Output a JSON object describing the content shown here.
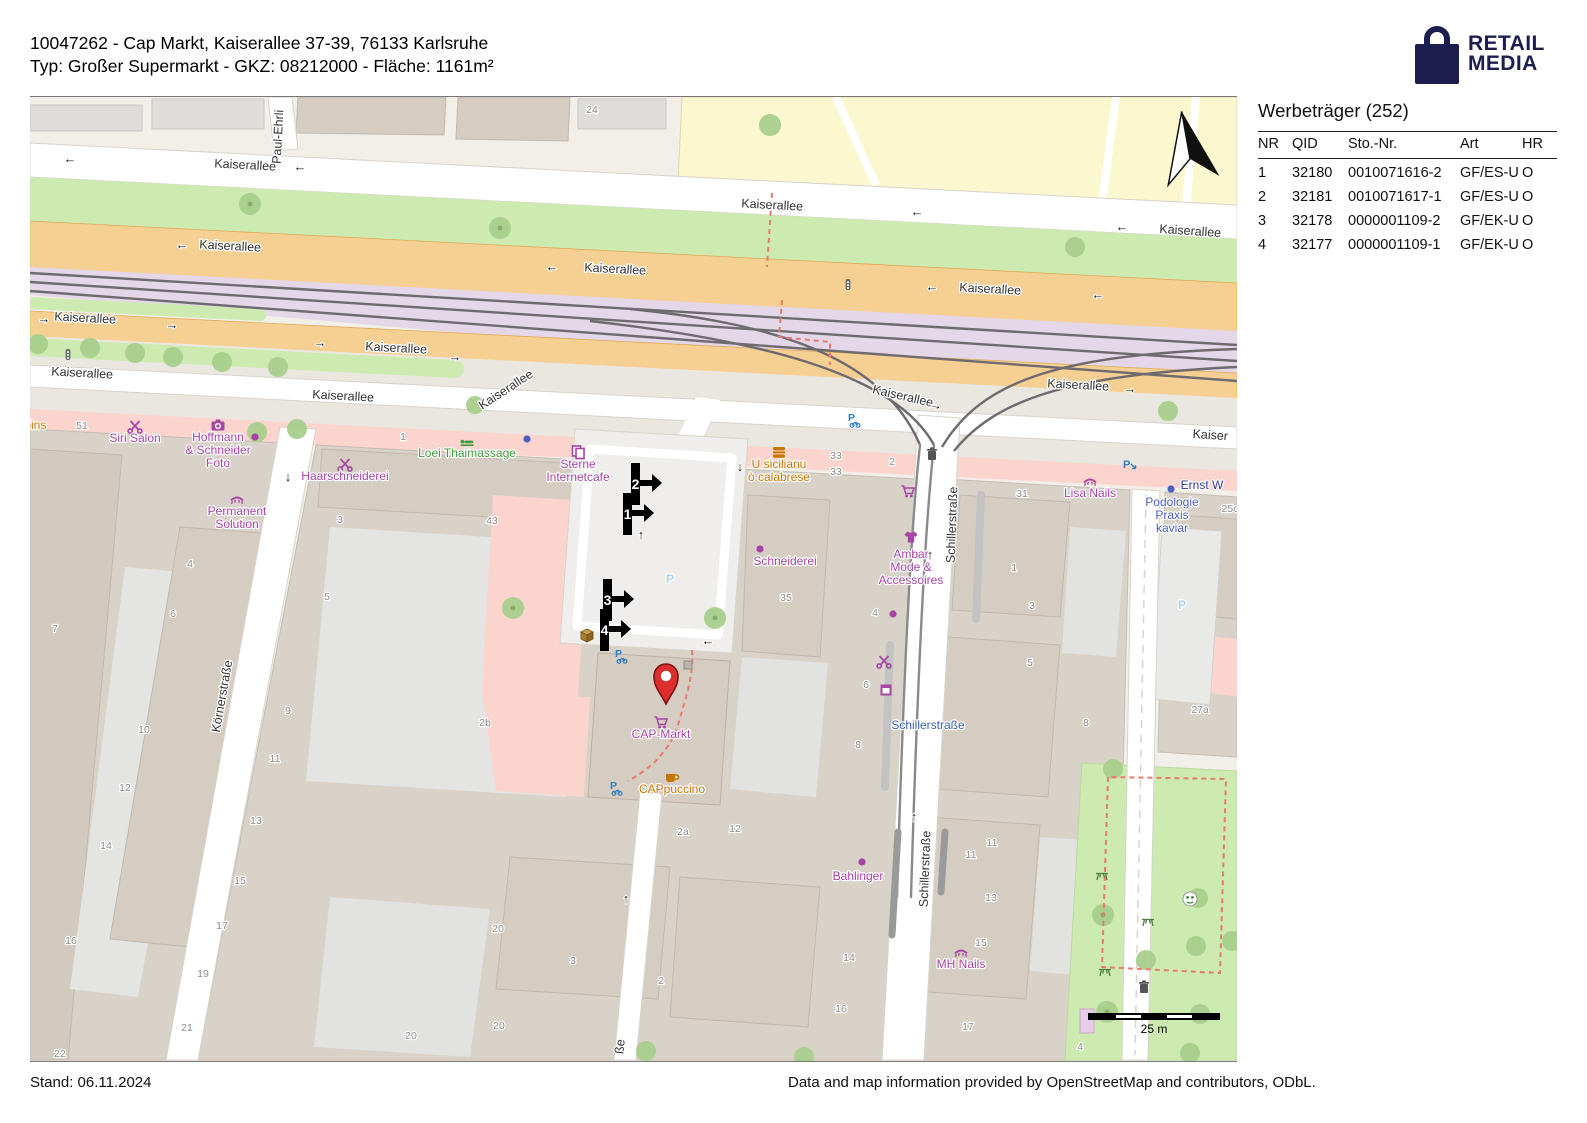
{
  "header": {
    "line1": "10047262 - Cap Markt, Kaiserallee 37-39, 76133 Karlsruhe",
    "line2": "Typ: Großer Supermarkt - GKZ: 08212000 - Fläche: 1161m²"
  },
  "logo": {
    "line1": "RETAIL",
    "line2": "MEDIA",
    "color": "#1d1d4f"
  },
  "panel": {
    "title": "Werbeträger (252)",
    "columns": [
      "NR",
      "QID",
      "Sto.-Nr.",
      "Art",
      "HR"
    ],
    "rows": [
      {
        "nr": "1",
        "qid": "32180",
        "sto": "0010071616-2",
        "art": "GF/ES-U",
        "hr": "O"
      },
      {
        "nr": "2",
        "qid": "32181",
        "sto": "0010071617-1",
        "art": "GF/ES-U",
        "hr": "O"
      },
      {
        "nr": "3",
        "qid": "32178",
        "sto": "0000001109-2",
        "art": "GF/EK-U",
        "hr": "O"
      },
      {
        "nr": "4",
        "qid": "32177",
        "sto": "0000001109-1",
        "art": "GF/EK-U",
        "hr": "O"
      }
    ]
  },
  "footer": {
    "stand": "Stand: 06.11.2024",
    "attribution": "Data and map information provided by OpenStreetMap and contributors, ODbL."
  },
  "map": {
    "scale_label": "25 m",
    "colors": {
      "road_orange": "#f6cf92",
      "tram_purple": "#e3d7e8",
      "grass_green": "#cdebb0",
      "pink_zone": "#fbd4cd",
      "yellow_zone": "#fbf8cf",
      "building": "#d6cdc2",
      "poi_purple": "#a645a6",
      "poi_orange": "#c77400",
      "poi_green": "#3f9c39",
      "poi_blue": "#4a5fc0",
      "stop_blue": "#3c5fae",
      "parking_blue": "#aed2ee",
      "bike_blue": "#2e7ec2",
      "pin_red": "#dd2e2e",
      "marker_black": "#000000"
    },
    "street_labels": [
      {
        "t": "Kaiserallee",
        "x": 215,
        "y": 72,
        "r": 3
      },
      {
        "t": "Kaiserallee",
        "x": 742,
        "y": 112,
        "r": 3
      },
      {
        "t": "Kaiserallee",
        "x": 1160,
        "y": 138,
        "r": 4
      },
      {
        "t": "Kaiserallee",
        "x": 200,
        "y": 153,
        "r": 3
      },
      {
        "t": "Kaiserallee",
        "x": 585,
        "y": 176,
        "r": 3
      },
      {
        "t": "Kaiserallee",
        "x": 960,
        "y": 196,
        "r": 3
      },
      {
        "t": "Kaiserallee",
        "x": 55,
        "y": 225,
        "r": 3
      },
      {
        "t": "Kaiserallee",
        "x": 366,
        "y": 255,
        "r": 3
      },
      {
        "t": "Kaiserallee",
        "x": 1048,
        "y": 292,
        "r": 3
      },
      {
        "t": "Kaiserallee",
        "x": 52,
        "y": 280,
        "r": 3
      },
      {
        "t": "Kaiserallee",
        "x": 313,
        "y": 303,
        "r": 3
      },
      {
        "t": "Kaiserallee",
        "x": 478,
        "y": 296,
        "r": -33
      },
      {
        "t": "Kaiserallee",
        "x": 872,
        "y": 303,
        "r": 13
      },
      {
        "t": "Kaiser",
        "x": 1180,
        "y": 342,
        "r": 4
      },
      {
        "t": "Paul-Ehrli",
        "x": 252,
        "y": 40,
        "r": -87
      },
      {
        "t": "Körnerstraße",
        "x": 196,
        "y": 600,
        "r": -80
      },
      {
        "t": "Schillerstraße",
        "x": 926,
        "y": 428,
        "r": -88
      },
      {
        "t": "Schillerstraße",
        "x": 899,
        "y": 772,
        "r": -88
      },
      {
        "t": "ße",
        "x": 594,
        "y": 950,
        "r": -84
      }
    ],
    "arrows": [
      {
        "t": "←",
        "x": 40,
        "y": 66
      },
      {
        "t": "←",
        "x": 270,
        "y": 74
      },
      {
        "t": "←",
        "x": 887,
        "y": 119
      },
      {
        "t": "←",
        "x": 1092,
        "y": 134
      },
      {
        "t": "←",
        "x": 152,
        "y": 152
      },
      {
        "t": "←",
        "x": 522,
        "y": 174
      },
      {
        "t": "←",
        "x": 902,
        "y": 194
      },
      {
        "t": "←",
        "x": 1068,
        "y": 202
      },
      {
        "t": "→",
        "x": 14,
        "y": 226
      },
      {
        "t": "→",
        "x": 142,
        "y": 232
      },
      {
        "t": "→",
        "x": 290,
        "y": 250
      },
      {
        "t": "→",
        "x": 425,
        "y": 264
      },
      {
        "t": "→",
        "x": 1100,
        "y": 296
      },
      {
        "t": "→",
        "x": 905,
        "y": 312,
        "r": 13
      },
      {
        "t": "↓",
        "x": 258,
        "y": 384
      },
      {
        "t": "↑",
        "x": 900,
        "y": 462
      },
      {
        "t": "↑",
        "x": 884,
        "y": 724
      },
      {
        "t": "↑",
        "x": 596,
        "y": 806
      },
      {
        "t": "↓",
        "x": 710,
        "y": 374
      },
      {
        "t": "←",
        "x": 678,
        "y": 548
      },
      {
        "t": "↑",
        "x": 611,
        "y": 442
      }
    ],
    "house_numbers": [
      {
        "t": "24",
        "x": 562,
        "y": 16
      },
      {
        "t": "51",
        "x": 52,
        "y": 332
      },
      {
        "t": "1",
        "x": 373,
        "y": 343
      },
      {
        "t": "43",
        "x": 462,
        "y": 427
      },
      {
        "t": "3",
        "x": 310,
        "y": 426
      },
      {
        "t": "5",
        "x": 297,
        "y": 503
      },
      {
        "t": "4",
        "x": 160,
        "y": 470
      },
      {
        "t": "6",
        "x": 143,
        "y": 520
      },
      {
        "t": "7",
        "x": 25,
        "y": 535
      },
      {
        "t": "2b",
        "x": 455,
        "y": 629
      },
      {
        "t": "9",
        "x": 258,
        "y": 617
      },
      {
        "t": "10",
        "x": 114,
        "y": 636
      },
      {
        "t": "11",
        "x": 245,
        "y": 665
      },
      {
        "t": "12",
        "x": 95,
        "y": 694
      },
      {
        "t": "13",
        "x": 226,
        "y": 727
      },
      {
        "t": "14",
        "x": 76,
        "y": 752
      },
      {
        "t": "15",
        "x": 210,
        "y": 787
      },
      {
        "t": "16",
        "x": 41,
        "y": 847
      },
      {
        "t": "17",
        "x": 192,
        "y": 832
      },
      {
        "t": "19",
        "x": 173,
        "y": 880
      },
      {
        "t": "21",
        "x": 157,
        "y": 934
      },
      {
        "t": "22",
        "x": 30,
        "y": 960
      },
      {
        "t": "20",
        "x": 468,
        "y": 835
      },
      {
        "t": "3",
        "x": 543,
        "y": 867
      },
      {
        "t": "2",
        "x": 631,
        "y": 887
      },
      {
        "t": "20",
        "x": 469,
        "y": 932
      },
      {
        "t": "20",
        "x": 381,
        "y": 942
      },
      {
        "t": "35",
        "x": 756,
        "y": 504
      },
      {
        "t": "33",
        "x": 806,
        "y": 362
      },
      {
        "t": "33",
        "x": 806,
        "y": 378
      },
      {
        "t": "2",
        "x": 862,
        "y": 368
      },
      {
        "t": "4",
        "x": 845,
        "y": 519
      },
      {
        "t": "31",
        "x": 992,
        "y": 400
      },
      {
        "t": "1",
        "x": 984,
        "y": 474
      },
      {
        "t": "3",
        "x": 1002,
        "y": 512
      },
      {
        "t": "5",
        "x": 1000,
        "y": 569
      },
      {
        "t": "6",
        "x": 836,
        "y": 591
      },
      {
        "t": "27a",
        "x": 1170,
        "y": 616
      },
      {
        "t": "8",
        "x": 1056,
        "y": 629
      },
      {
        "t": "8",
        "x": 828,
        "y": 651
      },
      {
        "t": "11",
        "x": 962,
        "y": 749
      },
      {
        "t": "11",
        "x": 941,
        "y": 761
      },
      {
        "t": "13",
        "x": 961,
        "y": 804
      },
      {
        "t": "15",
        "x": 951,
        "y": 849
      },
      {
        "t": "14",
        "x": 819,
        "y": 864
      },
      {
        "t": "16",
        "x": 811,
        "y": 915
      },
      {
        "t": "17",
        "x": 938,
        "y": 933
      },
      {
        "t": "2a",
        "x": 653,
        "y": 738
      },
      {
        "t": "12",
        "x": 705,
        "y": 735
      },
      {
        "t": "4",
        "x": 1050,
        "y": 953
      },
      {
        "t": "25c",
        "x": 1200,
        "y": 415
      }
    ],
    "pois": [
      {
        "lines": [
          "ppins"
        ],
        "x": 2,
        "y": 332,
        "color": "#c77400",
        "anchor": "start"
      },
      {
        "lines": [
          "Siri Salon"
        ],
        "x": 105,
        "y": 345,
        "color": "#a645a6",
        "icon": "scissors"
      },
      {
        "lines": [
          "Hoffmann",
          "& Schneider",
          "Foto"
        ],
        "x": 188,
        "y": 344,
        "color": "#a645a6",
        "icon": "camera"
      },
      {
        "lines": [
          "Haarschneiderei"
        ],
        "x": 315,
        "y": 383,
        "color": "#a645a6",
        "icon": "scissors"
      },
      {
        "lines": [
          "Permanent",
          "Solution"
        ],
        "x": 207,
        "y": 418,
        "color": "#a645a6",
        "icon": "lash"
      },
      {
        "lines": [
          "Loei Thaimassage"
        ],
        "x": 437,
        "y": 360,
        "color": "#3f9c39",
        "icon": "massage"
      },
      {
        "lines": [
          "Sterne",
          "Internetcafe"
        ],
        "x": 548,
        "y": 371,
        "color": "#a645a6",
        "icon": "copy"
      },
      {
        "lines": [
          "U sicilianu",
          "ò calabrese"
        ],
        "x": 749,
        "y": 371,
        "color": "#c77400",
        "icon": "burger"
      },
      {
        "lines": [
          "Schneiderei"
        ],
        "x": 755,
        "y": 468,
        "color": "#a645a6",
        "icon": "dot",
        "ix": 730,
        "iy": 452
      },
      {
        "lines": [
          "Ambar",
          "Mode &",
          "Accessoires"
        ],
        "x": 881,
        "y": 461,
        "color": "#a645a6",
        "icon": "tshirt",
        "iy": 440
      },
      {
        "lines": [
          "Lisa Nails"
        ],
        "x": 1060,
        "y": 400,
        "color": "#a645a6",
        "icon": "lash"
      },
      {
        "lines": [
          "Podologie",
          "Praxis",
          "kaviar"
        ],
        "x": 1142,
        "y": 409,
        "color": "#4a5fc0",
        "icon": "dot",
        "ix": 1141,
        "iy": 392
      },
      {
        "lines": [
          "Ernst W"
        ],
        "x": 1172,
        "y": 392,
        "color": "#2f3a8f",
        "anchor": "start"
      },
      {
        "lines": [
          "CAP-Markt"
        ],
        "x": 631,
        "y": 641,
        "color": "#a645a6",
        "icon": "cart"
      },
      {
        "lines": [
          "CAPpuccino"
        ],
        "x": 642,
        "y": 696,
        "color": "#c77400",
        "icon": "cup"
      },
      {
        "lines": [
          "Bahlinger"
        ],
        "x": 828,
        "y": 783,
        "color": "#a645a6",
        "icon": "dot",
        "ix": 832,
        "iy": 765
      },
      {
        "lines": [
          "MH Nails"
        ],
        "x": 931,
        "y": 871,
        "color": "#a645a6",
        "icon": "lash"
      },
      {
        "lines": [
          "Schillerstraße"
        ],
        "x": 898,
        "y": 632,
        "color": "#3c5fae",
        "size": 11
      },
      {
        "lines": [
          "P"
        ],
        "x": 640,
        "y": 486,
        "color": "#aed2ee",
        "size": 30,
        "bold": true
      },
      {
        "lines": [
          "P"
        ],
        "x": 1152,
        "y": 512,
        "color": "#aed2ee",
        "size": 22,
        "bold": true
      },
      {
        "icon": "cart",
        "ix": 878,
        "iy": 394,
        "color": "#a645a6"
      },
      {
        "icon": "scissors",
        "ix": 854,
        "iy": 564,
        "color": "#a645a6"
      },
      {
        "icon": "sq",
        "ix": 856,
        "iy": 593,
        "color": "#a645a6"
      },
      {
        "icon": "trash",
        "ix": 902,
        "iy": 357,
        "color": "#555555"
      },
      {
        "icon": "trash",
        "ix": 1114,
        "iy": 890,
        "color": "#555555"
      },
      {
        "icon": "box",
        "ix": 557,
        "iy": 538,
        "color": "#a87e2f"
      },
      {
        "icon": "dot",
        "ix": 225,
        "iy": 340,
        "color": "#a645a6"
      },
      {
        "icon": "dot",
        "ix": 497,
        "iy": 342,
        "color": "#4a5fc0"
      },
      {
        "icon": "dot",
        "ix": 863,
        "iy": 517,
        "color": "#a645a6"
      },
      {
        "icon": "signal",
        "ix": 818,
        "iy": 188,
        "color": "#666666"
      },
      {
        "icon": "signal",
        "ix": 38,
        "iy": 258,
        "color": "#666666"
      },
      {
        "icon": "pbike",
        "ix": 825,
        "iy": 323,
        "color": "#2e7ec2"
      },
      {
        "icon": "pbike",
        "ix": 592,
        "iy": 559,
        "color": "#2e7ec2"
      },
      {
        "icon": "pbike",
        "ix": 587,
        "iy": 691,
        "color": "#2e7ec2"
      },
      {
        "icon": "parrow",
        "ix": 1100,
        "iy": 368,
        "color": "#2e7ec2"
      },
      {
        "icon": "picnic",
        "ix": 1072,
        "iy": 778,
        "color": "#4e7e3e"
      },
      {
        "icon": "picnic",
        "ix": 1118,
        "iy": 824,
        "color": "#4e7e3e"
      },
      {
        "icon": "picnic",
        "ix": 1075,
        "iy": 874,
        "color": "#4e7e3e"
      },
      {
        "icon": "play",
        "ix": 1160,
        "iy": 802,
        "color": "#3e8b3e"
      }
    ],
    "markers": [
      {
        "n": "2",
        "x": 601,
        "y": 366
      },
      {
        "n": "1",
        "x": 593,
        "y": 396
      },
      {
        "n": "3",
        "x": 573,
        "y": 482
      },
      {
        "n": "4",
        "x": 570,
        "y": 512
      }
    ]
  }
}
